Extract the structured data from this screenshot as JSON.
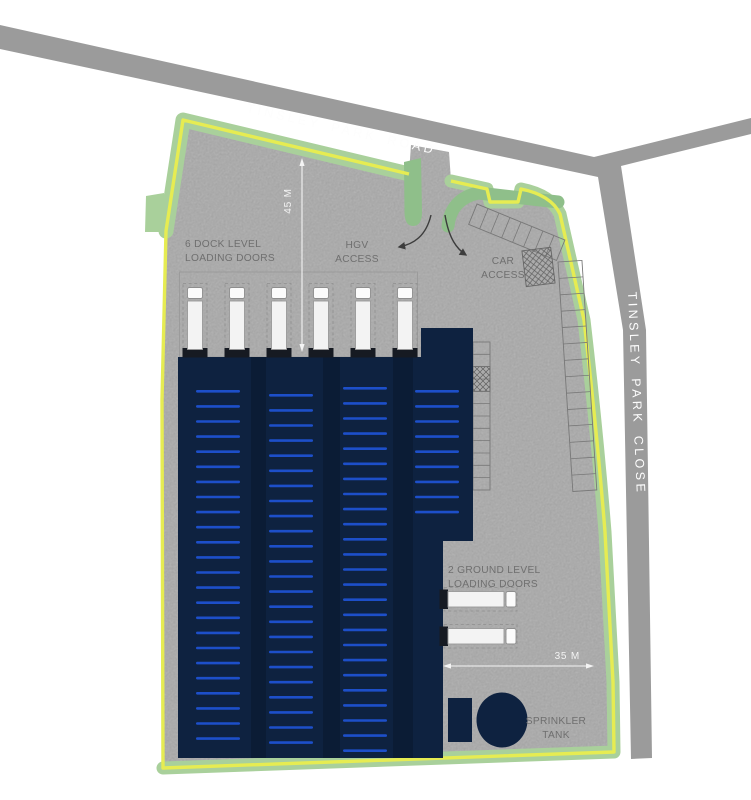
{
  "plan_title": "industrial unit site plan",
  "roads": {
    "top_label": "TINSLEY PARK ROAD",
    "right_label": "TINSLEY PARK CLOSE"
  },
  "annotations": {
    "dock_doors_line1": "6 DOCK LEVEL",
    "dock_doors_line2": "LOADING DOORS",
    "hgv_line1": "HGV",
    "hgv_line2": "ACCESS",
    "car_line1": "CAR",
    "car_line2": "ACCESS",
    "ground_doors_line1": "2 GROUND LEVEL",
    "ground_doors_line2": "LOADING DOORS",
    "sprinkler_line1": "SPRINKLER",
    "sprinkler_line2": "TANK"
  },
  "dimensions": {
    "vertical": "45 M",
    "horizontal": "35 M"
  },
  "counts": {
    "dock_level_loading_doors": 6,
    "ground_level_loading_doors": 2
  },
  "colors": {
    "building": "#0E2240",
    "building_divider": "#0B1C35",
    "rack_stripe": "#1D4FC9",
    "boundary_yellow": "#E6EC52",
    "landscaping_green": "#A9D09B",
    "landscaping_green_dark": "#8FBF8A",
    "road_gray": "#9B9B9B",
    "concrete_gray": "#BDBDBD",
    "label_gray": "#6F6F6F",
    "dimension_white": "#F4F4F4",
    "truck_white": "#F3F3F3",
    "door_dark": "#161A22"
  }
}
